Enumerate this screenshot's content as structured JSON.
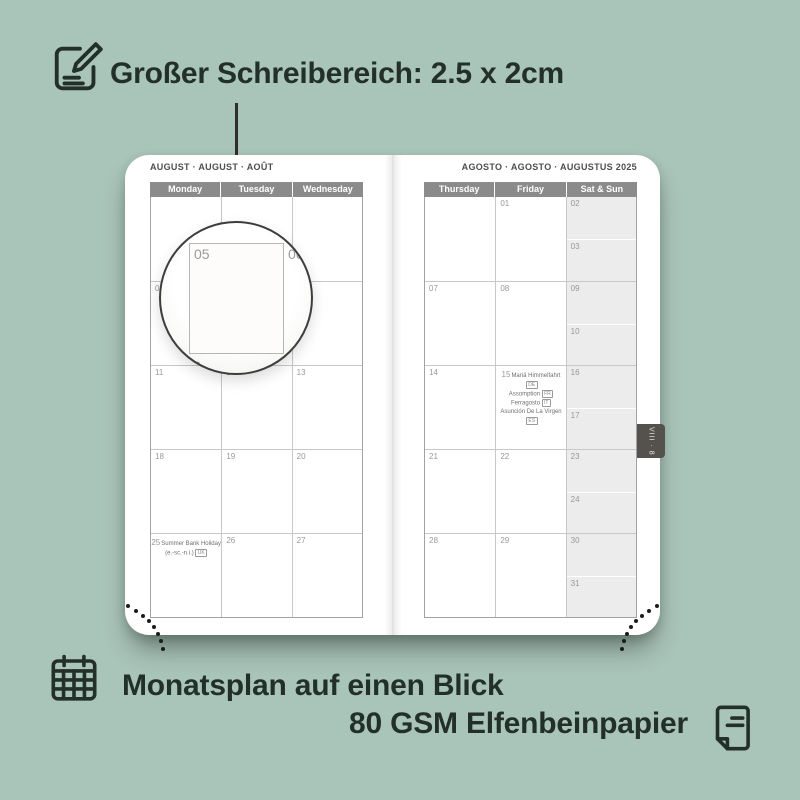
{
  "colors": {
    "background": "#a9c4b9",
    "text_dark": "#233029",
    "calendar_header": "#8b8b8b",
    "weekend_fill": "#ececec",
    "tab_fill": "#55524d"
  },
  "annotations": {
    "writing_area": "Großer Schreibereich: 2.5 x 2cm",
    "month_glance": "Monatsplan auf einen Blick",
    "paper": "80 GSM Elfenbeinpapier"
  },
  "icons": {
    "writing_area": "note-pencil-icon",
    "month_glance": "calendar-grid-icon",
    "paper": "paper-page-icon"
  },
  "planner": {
    "left": {
      "title": "AUGUST · AUGUST · AOÛT",
      "headers": [
        "Monday",
        "Tuesday",
        "Wednesday"
      ],
      "rows": [
        [
          "",
          "",
          ""
        ],
        [
          "04",
          "05",
          "06"
        ],
        [
          "11",
          "12",
          "13"
        ],
        [
          "18",
          "19",
          "20"
        ],
        [
          "25",
          "26",
          "27"
        ]
      ],
      "holiday_25": {
        "date": "25",
        "name": "Summer Bank Holiday",
        "region": "(e.-sc.-n.i.)",
        "code": "UK"
      }
    },
    "right": {
      "title": "AGOSTO · AGOSTO · AUGUSTUS 2025",
      "headers": [
        "Thursday",
        "Friday",
        "Sat & Sun"
      ],
      "rows": [
        {
          "thu": "",
          "fri": "01",
          "sat": "02",
          "sun": "03"
        },
        {
          "thu": "07",
          "fri": "08",
          "sat": "09",
          "sun": "10"
        },
        {
          "thu": "14",
          "fri": "15",
          "sat": "16",
          "sun": "17"
        },
        {
          "thu": "21",
          "fri": "22",
          "sat": "23",
          "sun": "24"
        },
        {
          "thu": "28",
          "fri": "29",
          "sat": "30",
          "sun": "31"
        }
      ],
      "holidays_15": {
        "date": "15",
        "items": [
          {
            "name": "Mariä Himmelfahrt",
            "code": "DE"
          },
          {
            "name": "Assomption",
            "code": "FR"
          },
          {
            "name": "Ferragosto",
            "code": "IT"
          },
          {
            "name": "Asunción De La Virgen",
            "code": "ES"
          }
        ]
      }
    },
    "tab_label": "VIII · 8"
  },
  "magnifier": {
    "day": "05",
    "next_day": "06",
    "edge_fragment_left": "y",
    "edge_fragment_bottom": "2"
  }
}
